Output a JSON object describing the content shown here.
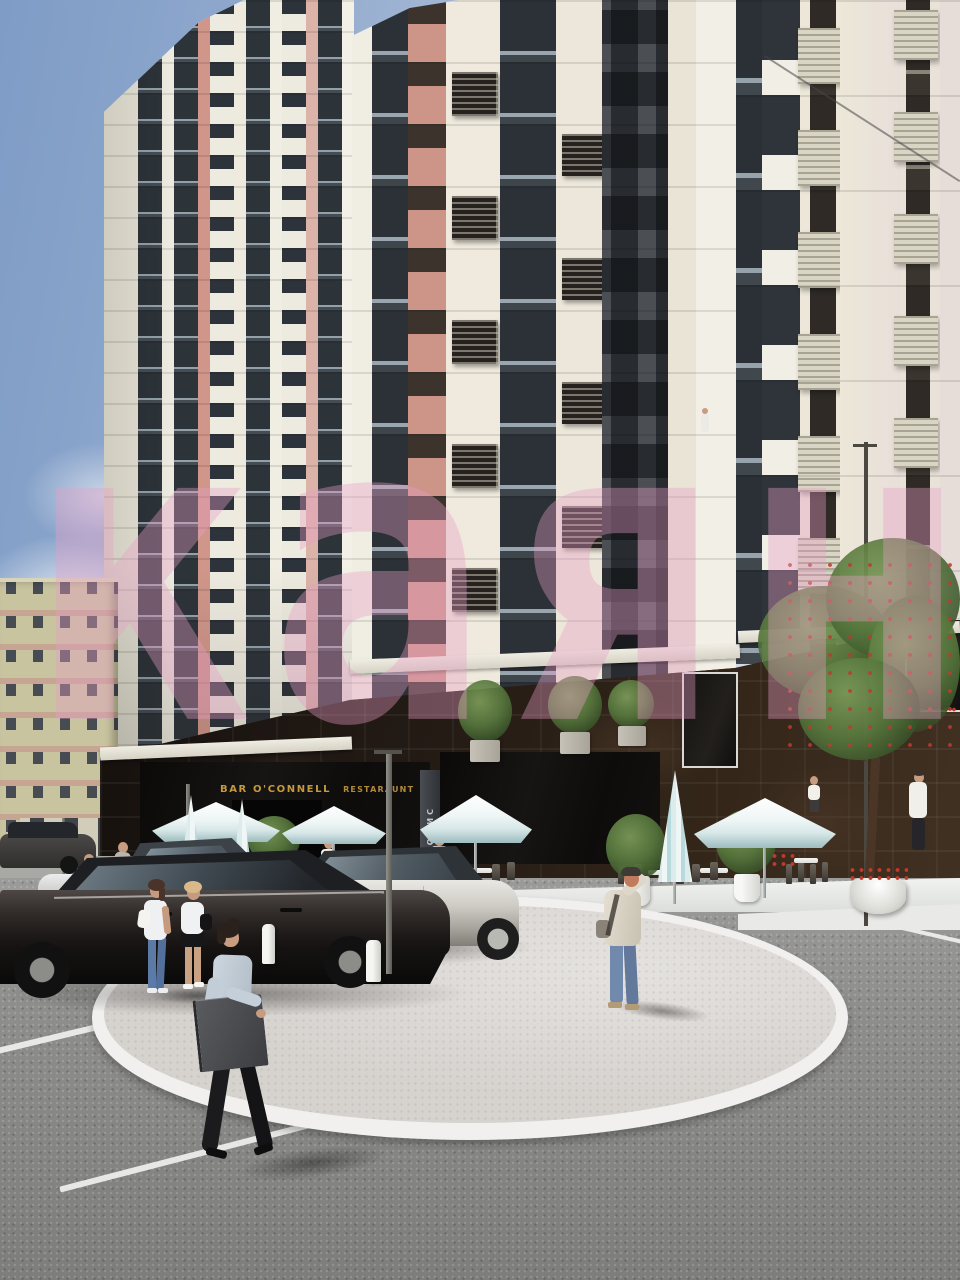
{
  "signs": {
    "bar_primary": "BAR O'CONNELL",
    "bar_secondary": "RESTARAUNT",
    "office_vertical": "ОФИС"
  },
  "watermark": {
    "text": "каян"
  },
  "palette": {
    "sky_blue": "#7e9cc6",
    "facade_white": "#efece2",
    "facade_cream": "#ece7d8",
    "glazing_dark": "#31373d",
    "accent_salmon": "#cd9488",
    "accent_pink": "#dcb3a8",
    "dark_brick": "#4b4e53",
    "old_building_wall": "#c9c4a0",
    "old_building_pink": "#c98c8c",
    "podium_stone": "#241b14",
    "sign_gold": "#c59a3e",
    "umbrella_white": "#f6f8f8",
    "umbrella_teal": "#badbde",
    "foliage_green": "#5a7c42",
    "bloom_red": "#bf392c",
    "asphalt": "#8e8e8c",
    "plaza_surface": "#d6d2ce",
    "curb_white": "#f1f0ee",
    "car_dark": "#26221f",
    "car_silver": "#cac8c1",
    "watermark_pink": "#e79ec4"
  }
}
